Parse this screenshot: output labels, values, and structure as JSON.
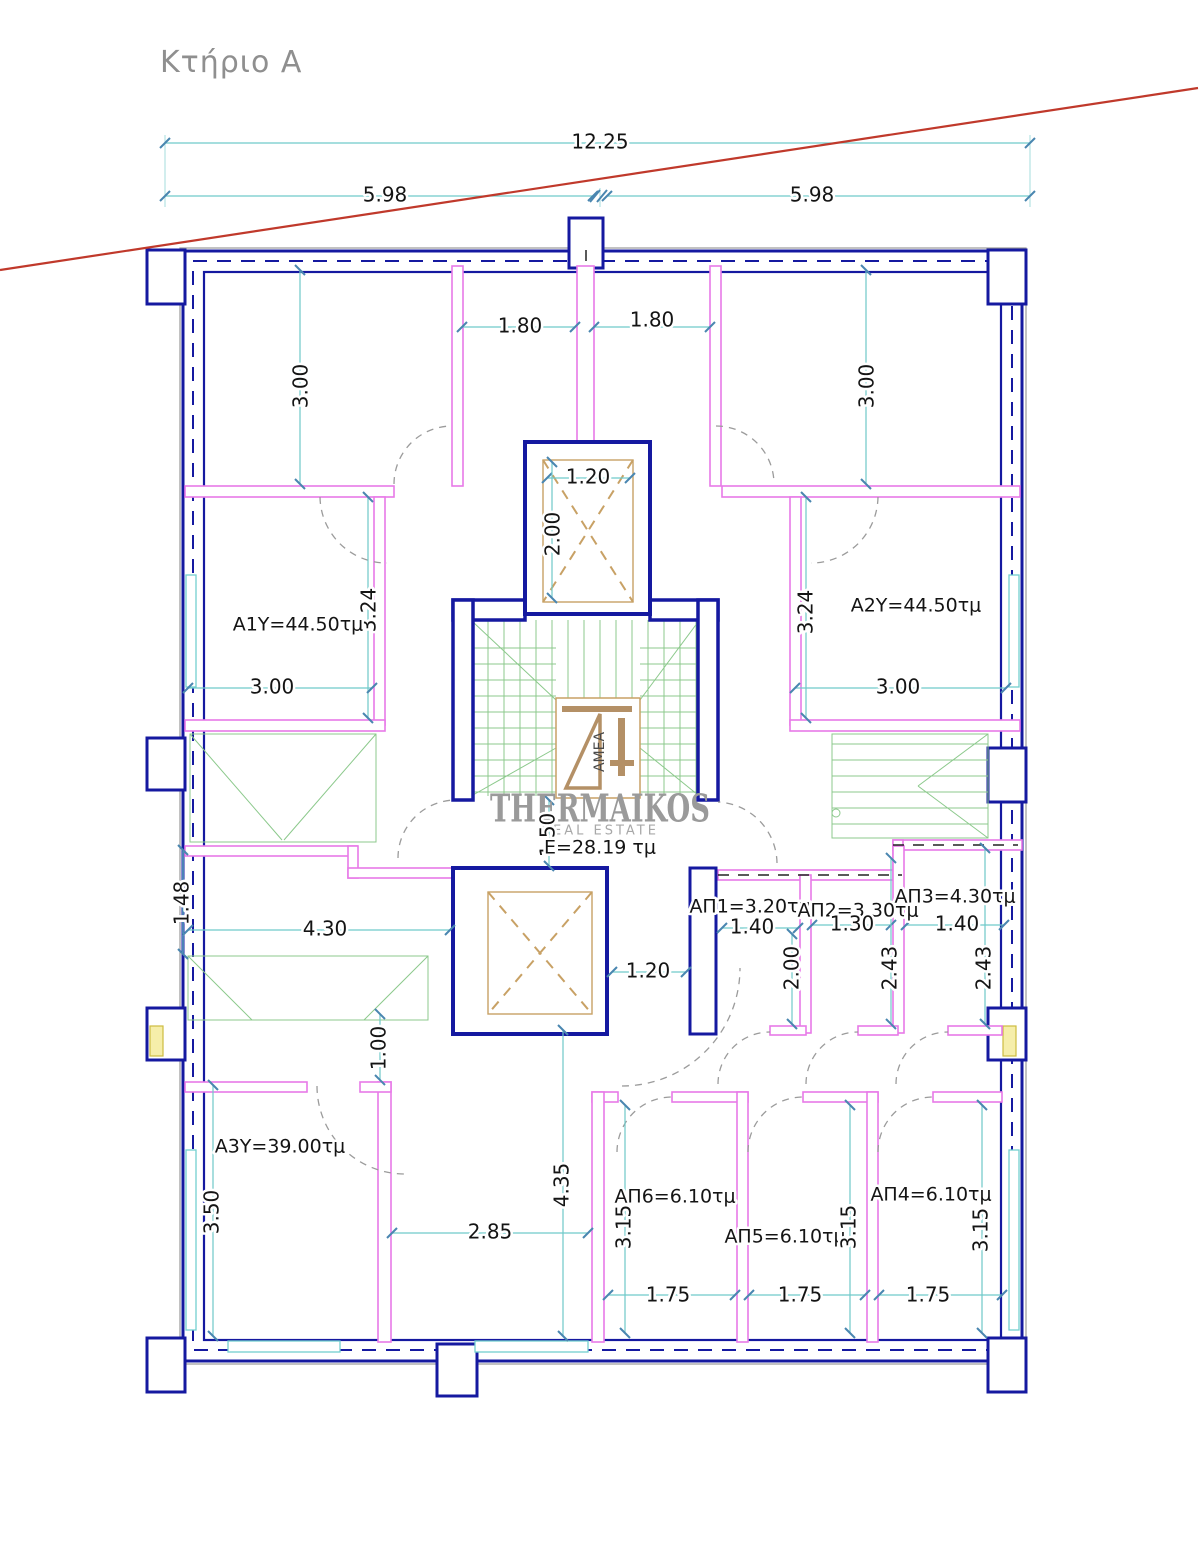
{
  "page": {
    "title": "Κτήριο Α"
  },
  "watermark": {
    "brand": "THERMAIKOS",
    "tagline": "REAL ESTATE",
    "area_label": "E=28.19 τμ",
    "logo_text": "ΑΜΕΑ"
  },
  "rooms": {
    "a1y": "A1Y=44.50τμ",
    "a2y": "A2Y=44.50τμ",
    "a3y": "A3Y=39.00τμ",
    "ap1": "ΑΠ1=3.20τμ",
    "ap2": "ΑΠ2=3.30τμ",
    "ap3": "ΑΠ3=4.30τμ",
    "ap4": "ΑΠ4=6.10τμ",
    "ap5": "ΑΠ5=6.10τμ",
    "ap6": "ΑΠ6=6.10τμ"
  },
  "dims": {
    "overall_width": "12.25",
    "left_half": "5.98",
    "right_half": "5.98",
    "top_left_gap": "1.80",
    "top_right_gap": "1.80",
    "upper_left_height": "3.00",
    "upper_right_height": "3.00",
    "shaft_width": "1.20",
    "shaft_height": "2.00",
    "a1y_height": "3.24",
    "a2y_height": "3.24",
    "a1y_width": "3.00",
    "a2y_width": "3.00",
    "left_recess": "1.48",
    "hall_width": "4.30",
    "stair_exit": "1.50",
    "ap1_width": "1.40",
    "ap2_width": "1.30",
    "ap3_width": "1.40",
    "ap1_height": "2.00",
    "ap2_height": "2.43",
    "ap3_height": "2.43",
    "lightwell_width": "1.20",
    "wall_segment": "1.00",
    "a3y_height": "3.50",
    "corridor_width": "2.85",
    "corridor_height": "4.35",
    "ap6_height": "3.15",
    "ap5_height": "3.15",
    "ap4_height": "3.15",
    "ap6_width": "1.75",
    "ap5_width": "1.75",
    "ap4_width": "1.75"
  },
  "colors": {
    "wall": "#1519a0",
    "partition": "#e87ae8",
    "dimension": "#6fc9c9",
    "stair": "#8cc98c",
    "shaft": "#c8a165",
    "boundary_line": "#c0392b",
    "door": "#9b9b9b",
    "text": "#141414",
    "title": "#8f8f8f",
    "watermark": "#9a9a9a"
  }
}
